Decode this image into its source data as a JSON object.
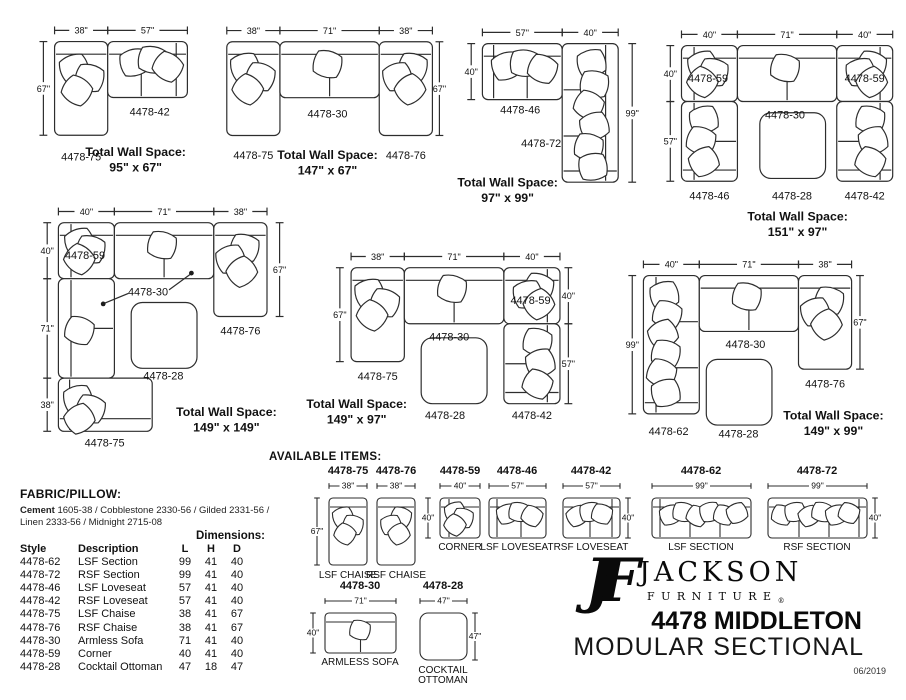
{
  "page": {
    "date": "06/2019"
  },
  "available_heading": "AVAILABLE ITEMS:",
  "fabric": {
    "heading": "FABRIC/PILLOW:",
    "lead": "Cement",
    "line1": " 1605-38 / Cobblestone 2330-56 / Gilded 2331-56 /",
    "line2": "Linen 2333-56 / Midnight 2715-08"
  },
  "table": {
    "dims_heading": "Dimensions:",
    "headers": [
      "Style",
      "Description",
      "L",
      "H",
      "D"
    ],
    "rows": [
      [
        "4478-62",
        "LSF Section",
        "99",
        "41",
        "40"
      ],
      [
        "4478-72",
        "RSF Section",
        "99",
        "41",
        "40"
      ],
      [
        "4478-46",
        "LSF Loveseat",
        "57",
        "41",
        "40"
      ],
      [
        "4478-42",
        "RSF Loveseat",
        "57",
        "41",
        "40"
      ],
      [
        "4478-75",
        "LSF Chaise",
        "38",
        "41",
        "67"
      ],
      [
        "4478-76",
        "RSF Chaise",
        "38",
        "41",
        "67"
      ],
      [
        "4478-30",
        "Armless Sofa",
        "71",
        "41",
        "40"
      ],
      [
        "4478-59",
        "Corner",
        "40",
        "41",
        "40"
      ],
      [
        "4478-28",
        "Cocktail Ottoman",
        "47",
        "18",
        "47"
      ]
    ]
  },
  "brand": {
    "monogram": "JF",
    "name": "JACKSON",
    "type": "FURNITURE",
    "reg": "®",
    "model": "4478 MIDDLETON",
    "product": "MODULAR SECTIONAL"
  },
  "configs": [
    {
      "total_heading": "Total Wall Space:",
      "total": "95\" x 67\"",
      "dims": [
        "38\"",
        "57\"",
        "67\""
      ],
      "labels": [
        "4478-75",
        "4478-42"
      ]
    },
    {
      "total_heading": "Total Wall Space:",
      "total": "147\" x 67\"",
      "dims": [
        "38\"",
        "71\"",
        "38\"",
        "67\""
      ],
      "labels": [
        "4478-75",
        "4478-30",
        "4478-76"
      ]
    },
    {
      "total_heading": "Total Wall Space:",
      "total": "97\" x 99\"",
      "dims": [
        "57\"",
        "40\"",
        "40\"",
        "99\""
      ],
      "labels": [
        "4478-46",
        "4478-72"
      ]
    },
    {
      "total_heading": "Total Wall Space:",
      "total": "151\" x 97\"",
      "dims": [
        "40\"",
        "71\"",
        "40\"",
        "40\"",
        "57\""
      ],
      "labels": [
        "4478-59",
        "4478-30",
        "4478-59",
        "4478-46",
        "4478-28",
        "4478-42"
      ]
    },
    {
      "total_heading": "Total Wall Space:",
      "total": "149\" x 149\"",
      "dims": [
        "40\"",
        "71\"",
        "38\"",
        "40\"",
        "71\"",
        "38\"",
        "67\""
      ],
      "labels": [
        "4478-59",
        "4478-30",
        "4478-76",
        "4478-28",
        "4478-75"
      ]
    },
    {
      "total_heading": "Total Wall Space:",
      "total": "149\" x 97\"",
      "dims": [
        "38\"",
        "71\"",
        "40\"",
        "67\"",
        "40\"",
        "57\""
      ],
      "labels": [
        "4478-75",
        "4478-30",
        "4478-59",
        "4478-28",
        "4478-42"
      ]
    },
    {
      "total_heading": "Total Wall Space:",
      "total": "149\" x 99\"",
      "dims": [
        "40\"",
        "71\"",
        "38\"",
        "99\"",
        "67\""
      ],
      "labels": [
        "4478-62",
        "4478-30",
        "4478-76",
        "4478-28"
      ]
    }
  ],
  "items": [
    {
      "id": "4478-75",
      "w": "38\"",
      "h": "67\"",
      "name": "LSF CHAISE"
    },
    {
      "id": "4478-76",
      "w": "38\"",
      "name": "RSF CHAISE"
    },
    {
      "id": "4478-59",
      "w": "40\"",
      "h": "40\"",
      "name": "CORNER"
    },
    {
      "id": "4478-46",
      "w": "57\"",
      "name": "LSF LOVESEAT"
    },
    {
      "id": "4478-42",
      "w": "57\"",
      "h": "40\"",
      "name": "RSF LOVESEAT"
    },
    {
      "id": "4478-62",
      "w": "99\"",
      "name": "LSF SECTION"
    },
    {
      "id": "4478-72",
      "w": "99\"",
      "h": "40\"",
      "name": "RSF SECTION"
    },
    {
      "id": "4478-30",
      "w": "71\"",
      "h": "40\"",
      "name": "ARMLESS SOFA"
    },
    {
      "id": "4478-28",
      "w": "47\"",
      "h": "47\"",
      "name1": "COCKTAIL",
      "name2": "OTTOMAN"
    }
  ]
}
